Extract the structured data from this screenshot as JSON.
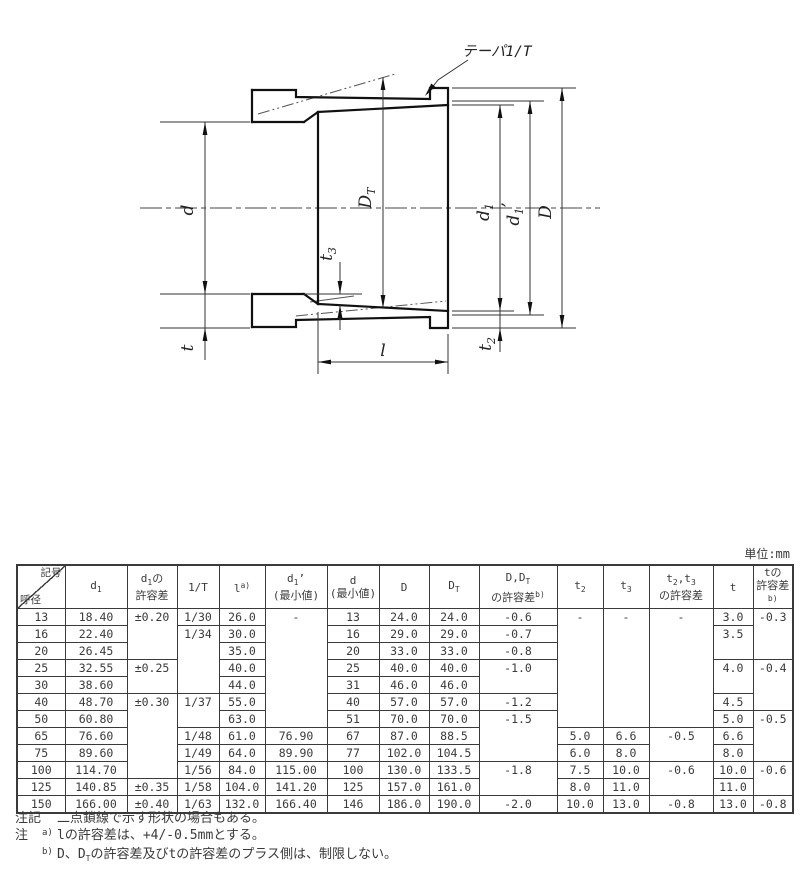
{
  "page": {
    "unit_label": "単位:mm"
  },
  "diagram": {
    "taper_label": "テーパ1/T",
    "labels": {
      "d": "d",
      "dt_main": "D",
      "dt_sub": "T",
      "d1_main": "d",
      "d1_sub": "1",
      "d1p_main": "d",
      "d1p_sub": "1",
      "d1p_prime": "’",
      "dd": "D",
      "t3_main": "t",
      "t3_sub": "3",
      "t": "t",
      "t2_main": "t",
      "t2_sub": "2",
      "l": "l"
    }
  },
  "table": {
    "header": [
      {
        "diagonal": true,
        "tr": "記号",
        "bl": "呼径"
      },
      {
        "lines": [
          [
            {
              "t": "d"
            },
            {
              "t": "1",
              "sub": 1
            }
          ]
        ]
      },
      {
        "lines": [
          [
            {
              "t": "d"
            },
            {
              "t": "1",
              "sub": 1
            },
            {
              "t": "の"
            }
          ],
          [
            {
              "t": "許容差"
            }
          ]
        ]
      },
      {
        "lines": [
          [
            {
              "t": "1/T"
            }
          ]
        ]
      },
      {
        "lines": [
          [
            {
              "t": "l"
            },
            {
              "t": "a)",
              "sup": 1
            }
          ]
        ]
      },
      {
        "lines": [
          [
            {
              "t": "d"
            },
            {
              "t": "1",
              "sub": 1
            },
            {
              "t": "’"
            }
          ],
          [
            {
              "t": "(最小値)"
            }
          ]
        ]
      },
      {
        "lines": [
          [
            {
              "t": "d"
            }
          ],
          [
            {
              "t": "(最小値)"
            }
          ]
        ]
      },
      {
        "lines": [
          [
            {
              "t": "D"
            }
          ]
        ]
      },
      {
        "lines": [
          [
            {
              "t": "D"
            },
            {
              "t": "T",
              "sub": 1
            }
          ]
        ]
      },
      {
        "lines": [
          [
            {
              "t": "D,D"
            },
            {
              "t": "T",
              "sub": 1
            }
          ],
          [
            {
              "t": "の許容差"
            },
            {
              "t": "b)",
              "sup": 1
            }
          ]
        ]
      },
      {
        "lines": [
          [
            {
              "t": "t"
            },
            {
              "t": "2",
              "sub": 1
            }
          ]
        ]
      },
      {
        "lines": [
          [
            {
              "t": "t"
            },
            {
              "t": "3",
              "sub": 1
            }
          ]
        ]
      },
      {
        "lines": [
          [
            {
              "t": "t"
            },
            {
              "t": "2",
              "sub": 1
            },
            {
              "t": ",t"
            },
            {
              "t": "3",
              "sub": 1
            }
          ],
          [
            {
              "t": "の許容差"
            }
          ]
        ]
      },
      {
        "lines": [
          [
            {
              "t": "t"
            }
          ]
        ]
      },
      {
        "lines": [
          [
            {
              "t": "tの"
            }
          ],
          [
            {
              "t": "許容差"
            },
            {
              "t": "b)",
              "sup": 1
            }
          ]
        ]
      }
    ],
    "rows": [
      {
        "c": [
          {
            "t": "13"
          },
          {
            "t": "18.40"
          },
          {
            "t": "±0.20",
            "rs": 3
          },
          {
            "t": "1/30"
          },
          {
            "t": "26.0"
          },
          {
            "t": "-",
            "rs": 7
          },
          {
            "t": "13"
          },
          {
            "t": "24.0"
          },
          {
            "t": "24.0"
          },
          {
            "t": "-0.6"
          },
          {
            "t": "-",
            "rs": 7
          },
          {
            "t": "-",
            "rs": 7
          },
          {
            "t": "-",
            "rs": 7
          },
          {
            "t": "3.0"
          },
          {
            "t": "-0.3",
            "rs": 3
          }
        ]
      },
      {
        "c": [
          {
            "t": "16"
          },
          {
            "t": "22.40"
          },
          {
            "t": "1/34",
            "rs": 4
          },
          {
            "t": "30.0"
          },
          {
            "t": "16"
          },
          {
            "t": "29.0"
          },
          {
            "t": "29.0"
          },
          {
            "t": "-0.7"
          },
          {
            "t": "3.5",
            "rs": 2
          }
        ]
      },
      {
        "c": [
          {
            "t": "20"
          },
          {
            "t": "26.45"
          },
          {
            "t": "35.0"
          },
          {
            "t": "20"
          },
          {
            "t": "33.0"
          },
          {
            "t": "33.0"
          },
          {
            "t": "-0.8"
          }
        ]
      },
      {
        "c": [
          {
            "t": "25"
          },
          {
            "t": "32.55"
          },
          {
            "t": "±0.25",
            "rs": 2
          },
          {
            "t": "40.0"
          },
          {
            "t": "25"
          },
          {
            "t": "40.0"
          },
          {
            "t": "40.0"
          },
          {
            "t": "-1.0",
            "rs": 2
          },
          {
            "t": "4.0",
            "rs": 2
          },
          {
            "t": "-0.4",
            "rs": 3
          }
        ]
      },
      {
        "c": [
          {
            "t": "30"
          },
          {
            "t": "38.60"
          },
          {
            "t": "44.0"
          },
          {
            "t": "31"
          },
          {
            "t": "46.0"
          },
          {
            "t": "46.0"
          }
        ]
      },
      {
        "c": [
          {
            "t": "40"
          },
          {
            "t": "48.70"
          },
          {
            "t": "±0.30",
            "rs": 5
          },
          {
            "t": "1/37",
            "rs": 2
          },
          {
            "t": "55.0"
          },
          {
            "t": "40"
          },
          {
            "t": "57.0"
          },
          {
            "t": "57.0"
          },
          {
            "t": "-1.2"
          },
          {
            "t": "4.5"
          }
        ]
      },
      {
        "c": [
          {
            "t": "50"
          },
          {
            "t": "60.80"
          },
          {
            "t": "63.0"
          },
          {
            "t": "51"
          },
          {
            "t": "70.0"
          },
          {
            "t": "70.0"
          },
          {
            "t": "-1.5",
            "rs": 3
          },
          {
            "t": "5.0"
          },
          {
            "t": "-0.5",
            "rs": 3
          }
        ]
      },
      {
        "c": [
          {
            "t": "65"
          },
          {
            "t": "76.60"
          },
          {
            "t": "1/48"
          },
          {
            "t": "61.0"
          },
          {
            "t": "76.90"
          },
          {
            "t": "67"
          },
          {
            "t": "87.0"
          },
          {
            "t": "88.5"
          },
          {
            "t": "5.0"
          },
          {
            "t": "6.6"
          },
          {
            "t": "-0.5",
            "rs": 2
          },
          {
            "t": "6.6"
          }
        ]
      },
      {
        "c": [
          {
            "t": "75"
          },
          {
            "t": "89.60"
          },
          {
            "t": "1/49"
          },
          {
            "t": "64.0"
          },
          {
            "t": "89.90"
          },
          {
            "t": "77"
          },
          {
            "t": "102.0"
          },
          {
            "t": "104.5"
          },
          {
            "t": "6.0"
          },
          {
            "t": "8.0"
          },
          {
            "t": "8.0"
          }
        ]
      },
      {
        "c": [
          {
            "t": "100"
          },
          {
            "t": "114.70"
          },
          {
            "t": "1/56"
          },
          {
            "t": "84.0"
          },
          {
            "t": "115.00"
          },
          {
            "t": "100"
          },
          {
            "t": "130.0"
          },
          {
            "t": "133.5"
          },
          {
            "t": "-1.8",
            "rs": 2
          },
          {
            "t": "7.5"
          },
          {
            "t": "10.0"
          },
          {
            "t": "-0.6",
            "rs": 2
          },
          {
            "t": "10.0"
          },
          {
            "t": "-0.6",
            "rs": 2
          }
        ]
      },
      {
        "c": [
          {
            "t": "125"
          },
          {
            "t": "140.85"
          },
          {
            "t": "±0.35"
          },
          {
            "t": "1/58"
          },
          {
            "t": "104.0"
          },
          {
            "t": "141.20"
          },
          {
            "t": "125"
          },
          {
            "t": "157.0"
          },
          {
            "t": "161.0"
          },
          {
            "t": "8.0"
          },
          {
            "t": "11.0"
          },
          {
            "t": "11.0"
          }
        ]
      },
      {
        "c": [
          {
            "t": "150"
          },
          {
            "t": "166.00"
          },
          {
            "t": "±0.40"
          },
          {
            "t": "1/63"
          },
          {
            "t": "132.0"
          },
          {
            "t": "166.40"
          },
          {
            "t": "146"
          },
          {
            "t": "186.0"
          },
          {
            "t": "190.0"
          },
          {
            "t": "-2.0"
          },
          {
            "t": "10.0"
          },
          {
            "t": "13.0"
          },
          {
            "t": "-0.8"
          },
          {
            "t": "13.0"
          },
          {
            "t": "-0.8"
          }
        ]
      }
    ]
  },
  "notes": [
    {
      "label": "注記",
      "sup": "",
      "parts": [
        {
          "t": "二点鎖線で示す形状の場合もある。"
        }
      ]
    },
    {
      "label": "注",
      "sup": "a)",
      "parts": [
        {
          "t": "lの許容差は、+4/-0.5mmとする。"
        }
      ]
    },
    {
      "label": "",
      "sup": "b)",
      "parts": [
        {
          "t": "D、D"
        },
        {
          "t": "T",
          "sub": 1
        },
        {
          "t": "の許容差及びtの許容差のプラス側は、制限しない。"
        }
      ]
    }
  ]
}
